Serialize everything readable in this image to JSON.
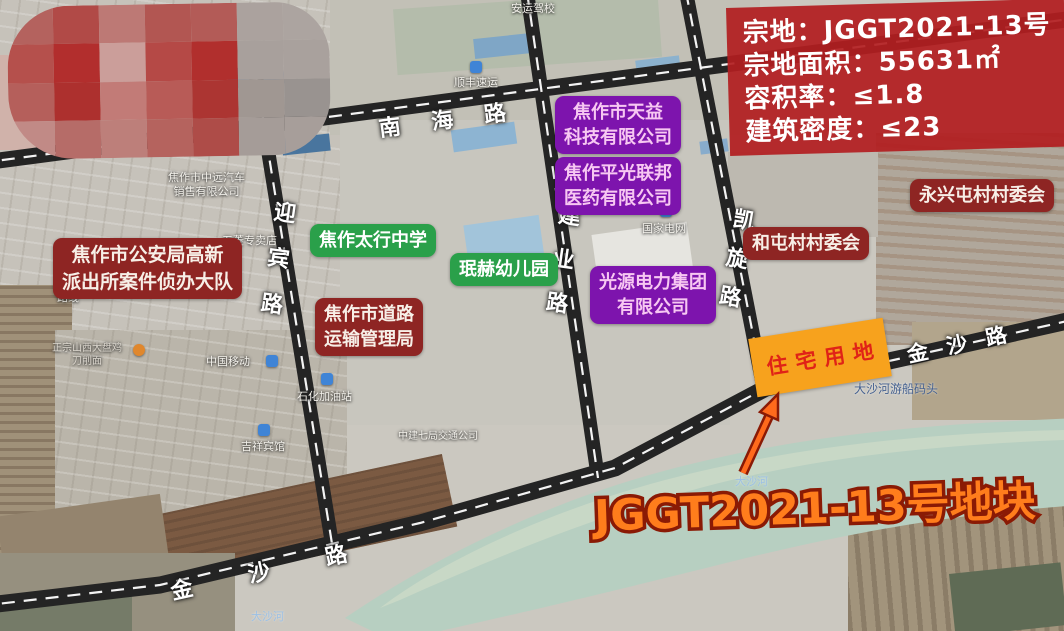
{
  "info_box": {
    "bg_color": "#b21e20",
    "lines": [
      "宗地：JGGT2021-13号",
      "宗地面积：55631㎡",
      "容积率：≤1.8",
      "建筑密度：≤23"
    ]
  },
  "plot_callout": {
    "text": "JGGT2021-13号地块",
    "fill_color": "#ff7d1c",
    "outline_color": "#8a1a05"
  },
  "parcel": {
    "label": "住宅用地",
    "fill_color": "#f7a21d",
    "text_color": "#e02317"
  },
  "road_labels": [
    "南海路",
    "迎宾路",
    "建业路",
    "凯旋路",
    "金沙路",
    "金沙路"
  ],
  "poi_labels": [
    {
      "text": "焦作市公安局高新\n派出所案件侦办大队",
      "type": "darkred"
    },
    {
      "text": "焦作市道路\n运输管理局",
      "type": "darkred"
    },
    {
      "text": "焦作太行中学",
      "type": "green"
    },
    {
      "text": "珉赫幼儿园",
      "type": "green"
    },
    {
      "text": "焦作市天益\n科技有限公司",
      "type": "purple"
    },
    {
      "text": "焦作平光联邦\n医药有限公司",
      "type": "purple"
    },
    {
      "text": "光源电力集团\n有限公司",
      "type": "purple"
    },
    {
      "text": "和屯村村委会",
      "type": "darkred"
    },
    {
      "text": "永兴屯村村委会",
      "type": "darkred"
    }
  ],
  "map_labels": [
    {
      "text": "安运驾校"
    },
    {
      "text": "顺丰速运"
    },
    {
      "text": "焦作市中远汽车\n销售有限公司"
    },
    {
      "text": "五菱专卖店"
    },
    {
      "text": "路线"
    },
    {
      "text": "正宗山西大盘鸡\n刀削面"
    },
    {
      "text": "中国移动"
    },
    {
      "text": "石化加油站"
    },
    {
      "text": "吉祥宾馆"
    },
    {
      "text": "中建七局交通公司"
    },
    {
      "text": "国家电网"
    },
    {
      "text": "大沙河游船码头"
    },
    {
      "text": "大沙河"
    },
    {
      "text": "大沙河"
    }
  ],
  "colors": {
    "road": "#242424",
    "road_centerline": "#ffffff",
    "river": "#b7cfc1",
    "poi_darkred": "#8e2523",
    "poi_green": "#2aa04a",
    "poi_purple": "#7d14ad"
  },
  "mosaic": {
    "cells": [
      "#b4625e",
      "#b14a47",
      "#bd7975",
      "#b25652",
      "#b35b57",
      "#aba29e",
      "#aca4a0",
      "#b5504c",
      "#b22e2d",
      "#cb9e9a",
      "#b54946",
      "#b12f2d",
      "#a8a09c",
      "#a9a19d",
      "#b55f5b",
      "#ad302e",
      "#c27b77",
      "#b85b57",
      "#ac3532",
      "#a09792",
      "#999390",
      "#c18a86",
      "#b66c68",
      "#bd7f7a",
      "#b5635e",
      "#ae4c48",
      "#a59c98",
      "#a79e9a"
    ]
  }
}
